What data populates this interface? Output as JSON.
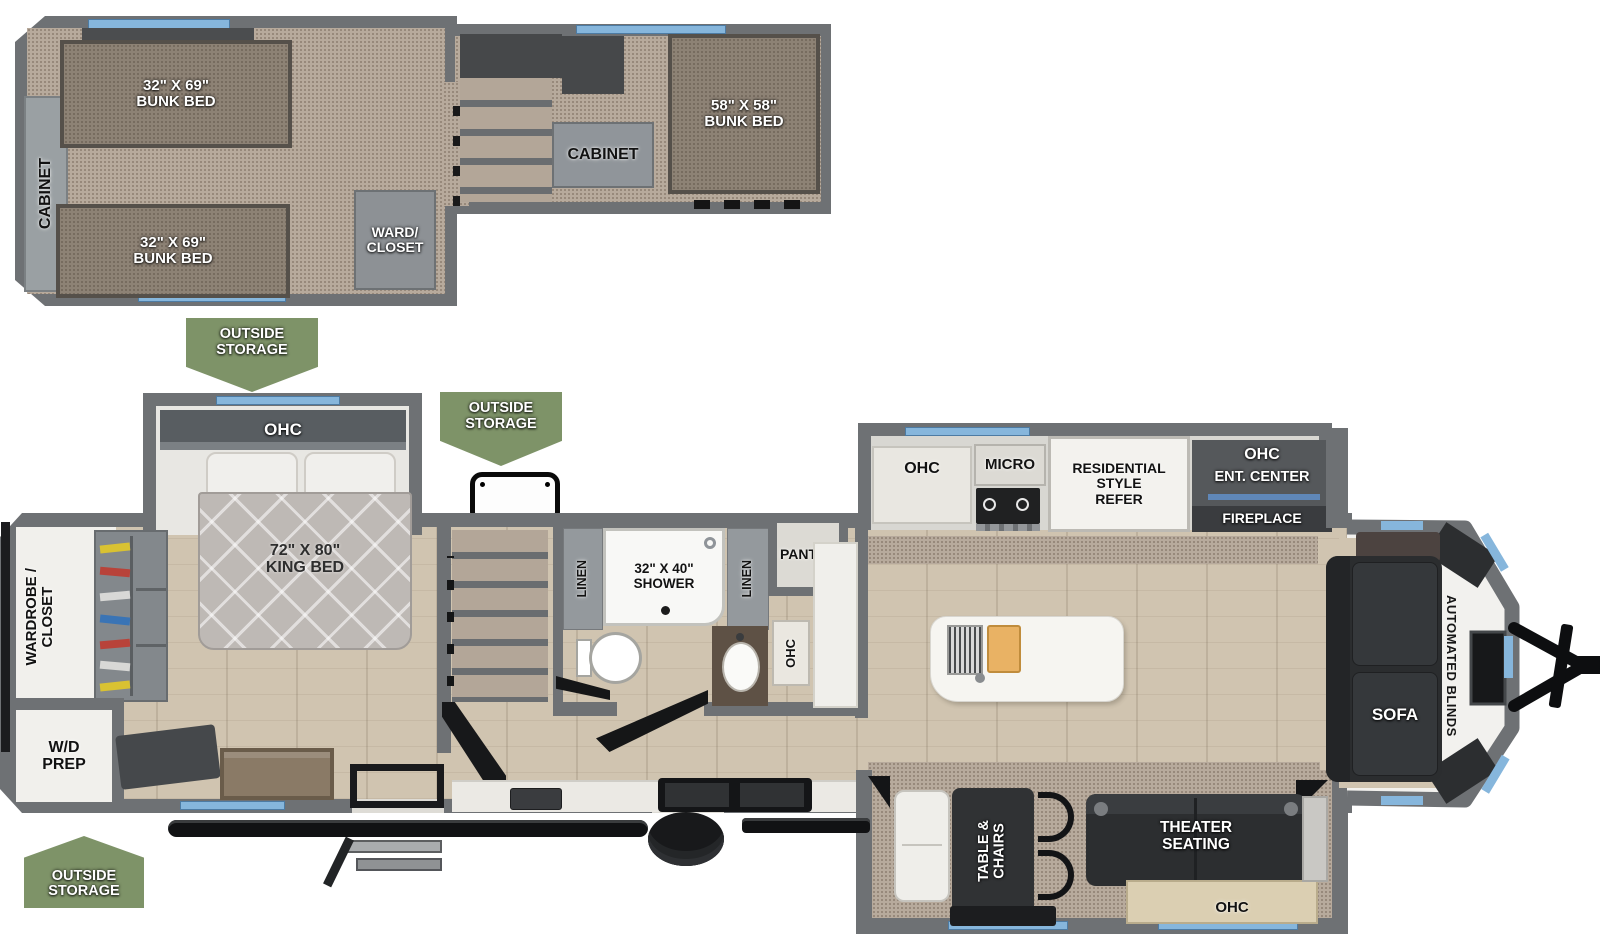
{
  "title": "RV destination trailer floor plan",
  "badges": {
    "outside_storage": "OUTSIDE\nSTORAGE"
  },
  "loft": {
    "cabinet_side": "CABINET",
    "bunk_left_top": "32\" X 69\"\nBUNK BED",
    "bunk_left_bottom": "32\" X 69\"\nBUNK BED",
    "ward_closet": "WARD/\nCLOSET",
    "cabinet_mid": "CABINET",
    "bunk_right": "58\" X 58\"\nBUNK BED"
  },
  "bedroom": {
    "ohc": "OHC",
    "king_bed": "72\" X 80\"\nKING BED",
    "wardrobe_closet": "WARDROBE /\nCLOSET",
    "wd_prep": "W/D\nPREP"
  },
  "bath": {
    "linen_left": "LINEN",
    "shower": "32\" X 40\"\nSHOWER",
    "linen_right": "LINEN",
    "pantry": "PANTRY",
    "ohc": "OHC"
  },
  "kitchen": {
    "ohc": "OHC",
    "micro": "MICRO",
    "refer": "RESIDENTIAL\nSTYLE\nREFER",
    "ohc_ent": "OHC",
    "ent_center": "ENT. CENTER",
    "fireplace": "FIREPLACE"
  },
  "living": {
    "sofa": "SOFA",
    "automated_blinds": "AUTOMATED BLINDS",
    "table_chairs": "TABLE &\nCHAIRS",
    "theater_seating": "THEATER\nSEATING",
    "ohc": "OHC"
  },
  "colors": {
    "wall_gray": "#6e7174",
    "carpet_tan": "#b7aa9c",
    "wood_floor": "#d0c4b0",
    "mattress_taupe": "#8d8275",
    "badge_green": "#7e9368",
    "window_blue": "#86b6dc",
    "furniture_dark": "#2c2e30",
    "fixture_white": "#f2f1ee"
  }
}
